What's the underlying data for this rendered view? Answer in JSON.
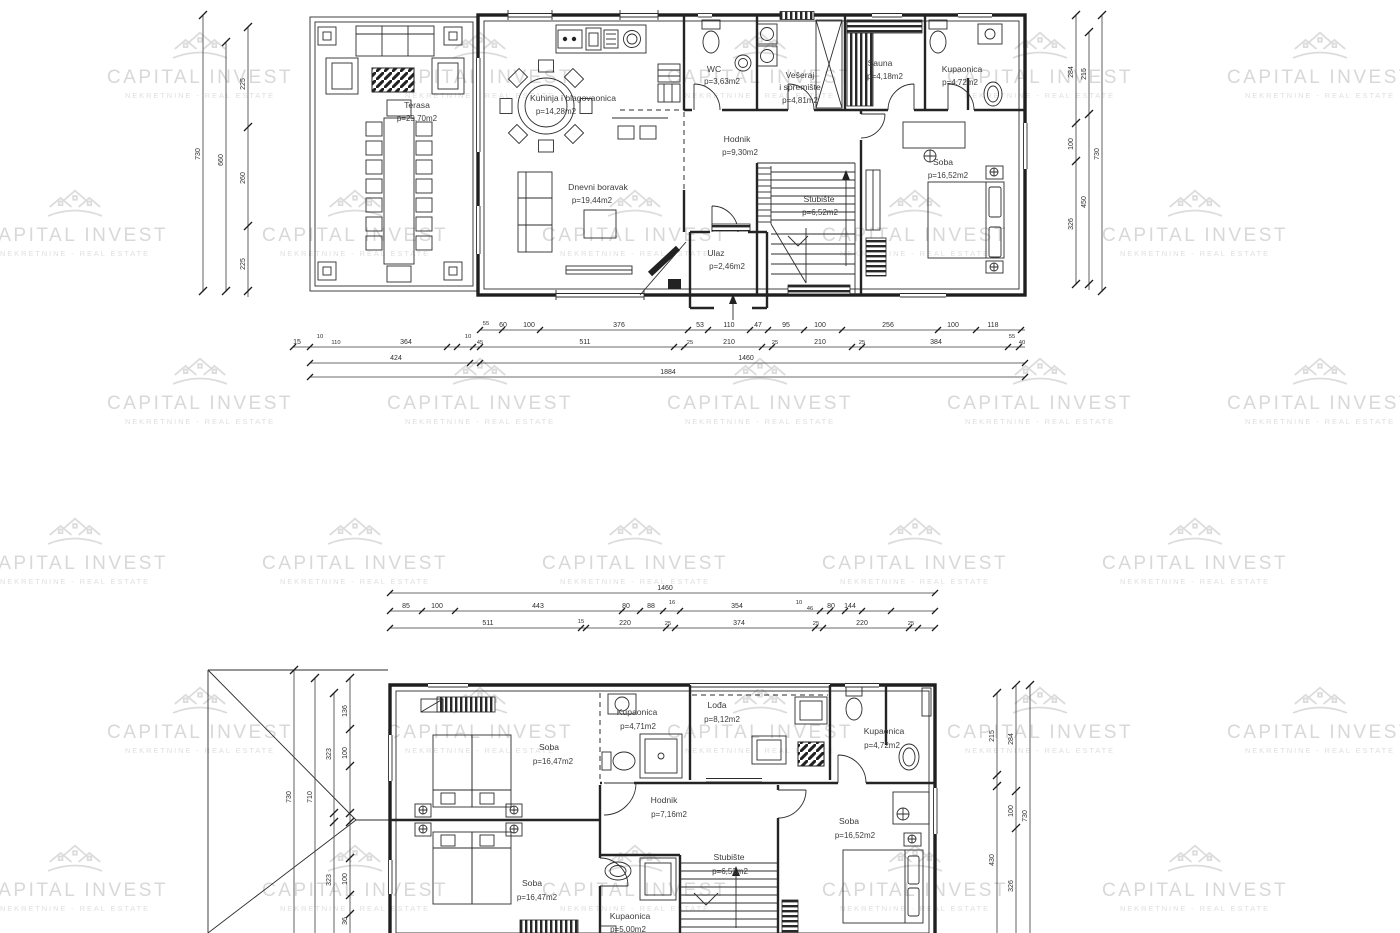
{
  "watermark": {
    "name": "CAPITAL INVEST",
    "subtitle": "NEKRETNINE - REAL ESTATE",
    "color": "#d8d8d8"
  },
  "drawing_colors": {
    "line": "#1f1f1f",
    "label": "#3c3c3c",
    "background": "#ffffff"
  },
  "ground_floor": {
    "rooms": {
      "terasa": [
        "Terasa",
        "p=29,70m2"
      ],
      "kuhinja": [
        "Kuhinja i blagovaonica",
        "p=14,28m2"
      ],
      "dnevni": [
        "Dnevni boravak",
        "p=19,44m2"
      ],
      "wc": [
        "WC",
        "p=3,63m2"
      ],
      "veseraj": [
        "Vešeraj",
        "i spremište",
        "p=4,81m2"
      ],
      "sauna": [
        "Sauna",
        "p=4,18m2"
      ],
      "kupaonica": [
        "Kupaonica",
        "p=4,72m2"
      ],
      "hodnik": [
        "Hodnik",
        "p=9,30m2"
      ],
      "stubiste": [
        "Stubište",
        "p=6,52m2"
      ],
      "soba": [
        "Soba",
        "p=16,52m2"
      ],
      "ulaz": [
        "Ulaz",
        "p=2,46m2"
      ]
    },
    "dims": {
      "row1": [
        "55",
        "60",
        "100",
        "376",
        "53",
        "110",
        "47",
        "95",
        "100",
        "256",
        "100",
        "118"
      ],
      "row2": [
        "15",
        "10",
        "110",
        "364",
        "10",
        "45",
        "511",
        "25",
        "210",
        "25",
        "210",
        "25",
        "384",
        "55",
        "40"
      ],
      "row3": [
        "424",
        "1460"
      ],
      "row4": [
        "1884"
      ],
      "left": [
        "730",
        "660",
        "225",
        "260",
        "225"
      ],
      "right": [
        "284",
        "100",
        "326",
        "215",
        "450",
        "730"
      ]
    }
  },
  "upper_floor": {
    "rooms": {
      "soba1": [
        "Soba",
        "p=16,47m2"
      ],
      "kupaonica1": [
        "Kupaonica",
        "p=4,71m2"
      ],
      "lodja": [
        "Lođa",
        "p=8,12m2"
      ],
      "kupaonica2": [
        "Kupaonica",
        "p=4,72m2"
      ],
      "hodnik": [
        "Hodnik",
        "p=7,16m2"
      ],
      "soba2": [
        "Soba",
        "p=16,52m2"
      ],
      "soba3": [
        "Soba",
        "p=16,47m2"
      ],
      "stubiste": [
        "Stubište",
        "p=6,52m2"
      ],
      "kupaonica3": [
        "Kupaonica",
        "p=5,00m2"
      ]
    },
    "dims": {
      "row0": [
        "1460"
      ],
      "row1": [
        "85",
        "100",
        "443",
        "80",
        "88",
        "16",
        "354",
        "10",
        "46",
        "80",
        "144"
      ],
      "row2": [
        "511",
        "15",
        "220",
        "25",
        "374",
        "25",
        "220",
        "25"
      ],
      "left": [
        "730",
        "710",
        "136",
        "323",
        "100",
        "323",
        "100",
        "36"
      ],
      "right": [
        "215",
        "430",
        "284",
        "100",
        "326",
        "730"
      ]
    }
  }
}
